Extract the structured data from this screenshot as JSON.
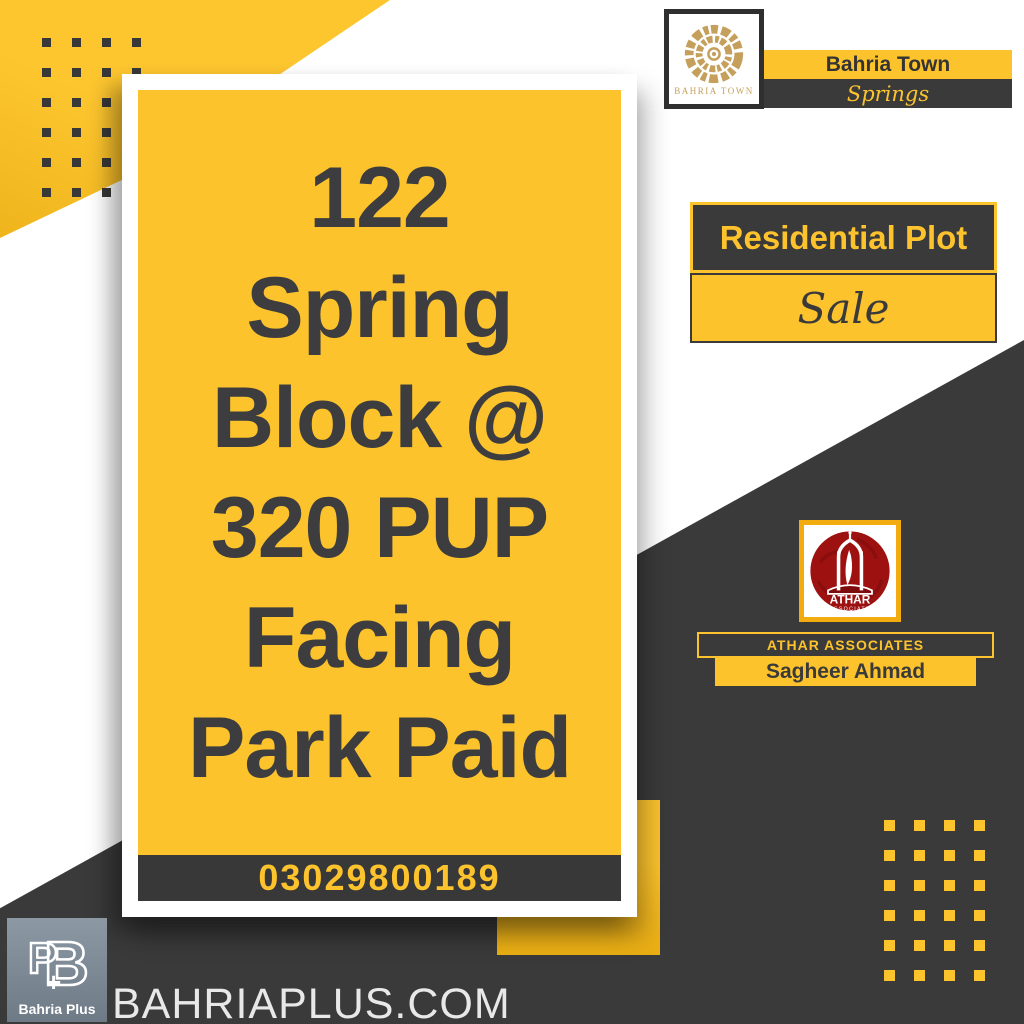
{
  "colors": {
    "yellow": "#FCC32D",
    "dark": "#3A3A3A",
    "gold": "#C5A05C",
    "logo_red": "#9E1111",
    "slate": "#7E8B96",
    "white": "#FFFFFF",
    "footer_text": "#E8E8E8"
  },
  "header": {
    "brand": "Bahria Town",
    "community": "Springs",
    "logo_caption": "BAHRIA TOWN"
  },
  "offer": {
    "property_type": "Residential Plot",
    "status": "Sale"
  },
  "listing": {
    "headline_lines": [
      "122",
      "Spring",
      "Block @",
      "320 PUP",
      "Facing",
      "Park Paid"
    ],
    "phone": "03029800189"
  },
  "agent": {
    "company": "ATHAR ASSOCIATES",
    "name": "Sagheer Ahmad",
    "logo_title": "ATHAR",
    "logo_subtitle": "ASSOCIATE"
  },
  "footer": {
    "website": "BAHRIAPLUS.COM",
    "logo_label": "Bahria Plus",
    "monogram_p": "P",
    "monogram_b": "B",
    "monogram_plus": "+"
  }
}
